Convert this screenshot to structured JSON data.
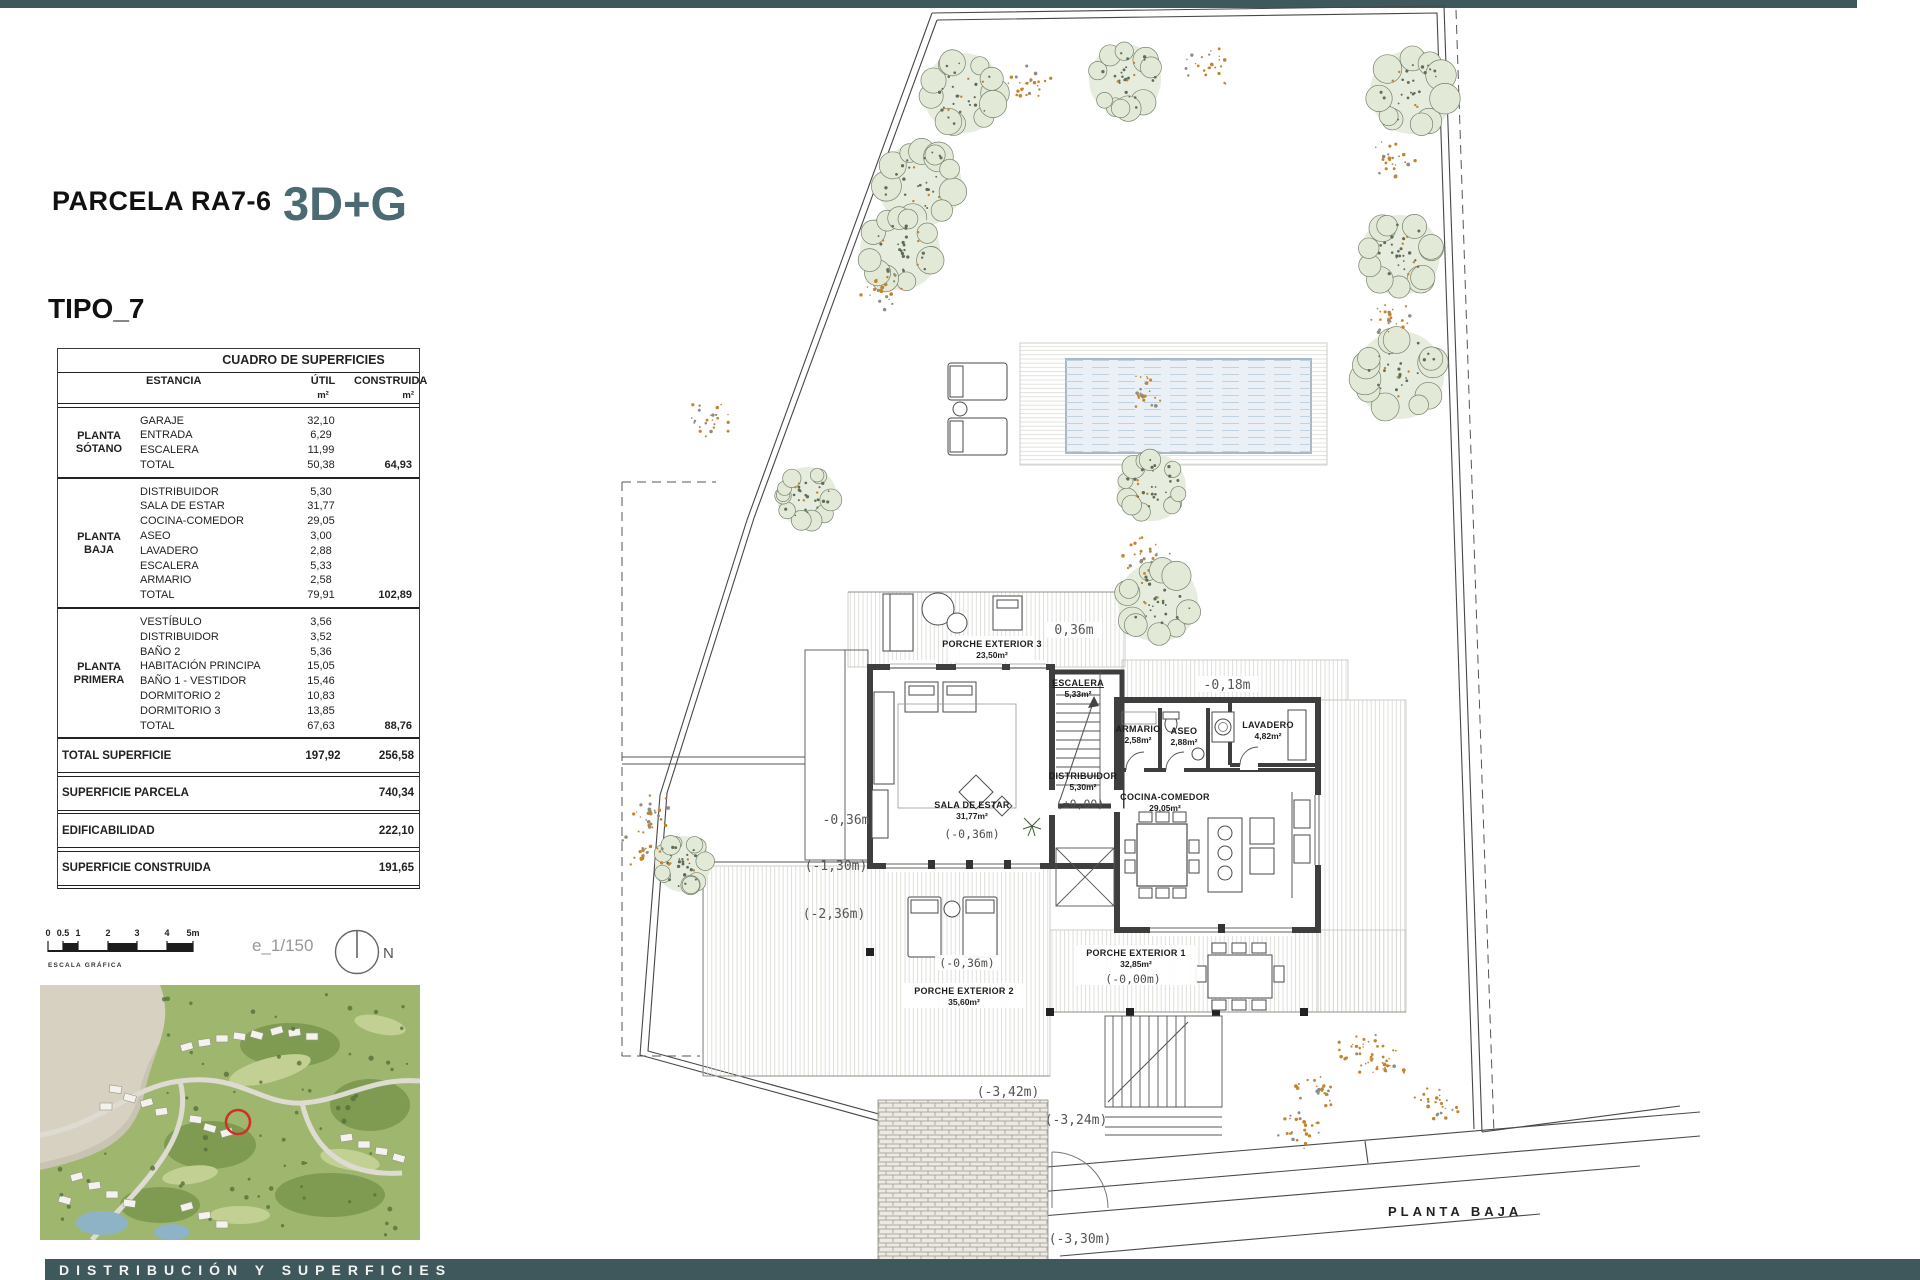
{
  "page": {
    "title": "PARCELA RA7-6",
    "badge": "3D+G",
    "subtitle": "TIPO_7",
    "footer": "DISTRIBUCIÓN Y SUPERFICIES",
    "scale_text": "e_1/150",
    "scale_caption": "ESCALA GRÁFICA",
    "scale_ticks": [
      "0",
      "0.5",
      "1",
      "2",
      "3",
      "4",
      "5m"
    ],
    "north_label": "N",
    "plan_title": "PLANTA BAJA"
  },
  "colors": {
    "accent_bar": "#3f585c",
    "badge": "#4b6a72",
    "marker_red": "#d03028",
    "tree_green": "#e7edde",
    "pool_water": "#eaf0f6"
  },
  "table": {
    "title": "CUADRO DE SUPERFICIES",
    "col_estancia": "ESTANCIA",
    "col_util": "ÚTIL",
    "col_construida": "CONSTRUIDA",
    "unit": "m²",
    "sections": [
      {
        "label": "PLANTA SÓTANO",
        "rows": [
          [
            "GARAJE",
            "32,10"
          ],
          [
            "ENTRADA",
            "6,29"
          ],
          [
            "ESCALERA",
            "11,99"
          ]
        ],
        "total": {
          "name": "TOTAL",
          "util": "50,38",
          "construida": "64,93"
        }
      },
      {
        "label": "PLANTA BAJA",
        "rows": [
          [
            "DISTRIBUIDOR",
            "5,30"
          ],
          [
            "SALA DE ESTAR",
            "31,77"
          ],
          [
            "COCINA-COMEDOR",
            "29,05"
          ],
          [
            "ASEO",
            "3,00"
          ],
          [
            "LAVADERO",
            "2,88"
          ],
          [
            "ESCALERA",
            "5,33"
          ],
          [
            "ARMARIO",
            "2,58"
          ]
        ],
        "total": {
          "name": "TOTAL",
          "util": "79,91",
          "construida": "102,89"
        }
      },
      {
        "label": "PLANTA PRIMERA",
        "rows": [
          [
            "VESTÍBULO",
            "3,56"
          ],
          [
            "DISTRIBUIDOR",
            "3,52"
          ],
          [
            "BAÑO 2",
            "5,36"
          ],
          [
            "HABITACIÓN PRINCIPA",
            "15,05"
          ],
          [
            "BAÑO 1 - VESTIDOR",
            "15,46"
          ],
          [
            "DORMITORIO 2",
            "10,83"
          ],
          [
            "DORMITORIO 3",
            "13,85"
          ]
        ],
        "total": {
          "name": "TOTAL",
          "util": "67,63",
          "construida": "88,76"
        }
      }
    ],
    "summary": [
      {
        "name": "TOTAL SUPERFICIE",
        "util": "197,92",
        "construida": "256,58"
      },
      {
        "name": "SUPERFICIE PARCELA",
        "util": "",
        "construida": "740,34"
      },
      {
        "name": "EDIFICABILIDAD",
        "util": "",
        "construida": "222,10"
      },
      {
        "name": "SUPERFICIE CONSTRUIDA",
        "util": "",
        "construida": "191,65"
      }
    ]
  },
  "plan": {
    "labels": {
      "porche3": "PORCHE EXTERIOR 3",
      "porche3_area": "23,50m²",
      "escalera": "ESCALERA",
      "escalera_area": "5,33m²",
      "armario": "ARMARIO",
      "armario_area": "2,58m²",
      "aseo": "ASEO",
      "aseo_area": "2,88m²",
      "lavadero": "LAVADERO",
      "lavadero_area": "4,82m²",
      "distribuidor": "DISTRIBUIDOR",
      "distribuidor_area": "5,30m²",
      "distribuidor_level": "(±0,00)",
      "cocina": "COCINA-COMEDOR",
      "cocina_area": "29,05m²",
      "sala": "SALA DE ESTAR",
      "sala_area": "31,77m²",
      "sala_level": "(-0,36m)",
      "porche2": "PORCHE EXTERIOR 2",
      "porche2_area": "35,60m²",
      "porche2_level": "(-0,36m)",
      "porche1": "PORCHE EXTERIOR 1",
      "porche1_area": "32,85m²",
      "porche1_level": "(-0,00m)",
      "m_036": "0,36m",
      "m_018": "-0,18m",
      "m_l036": "-0,36m",
      "m_130": "(-1,30m)",
      "m_236": "(-2,36m)",
      "m_342": "(-3,42m)",
      "m_324": "(-3,24m)",
      "m_330": "(-3,30m)"
    }
  }
}
